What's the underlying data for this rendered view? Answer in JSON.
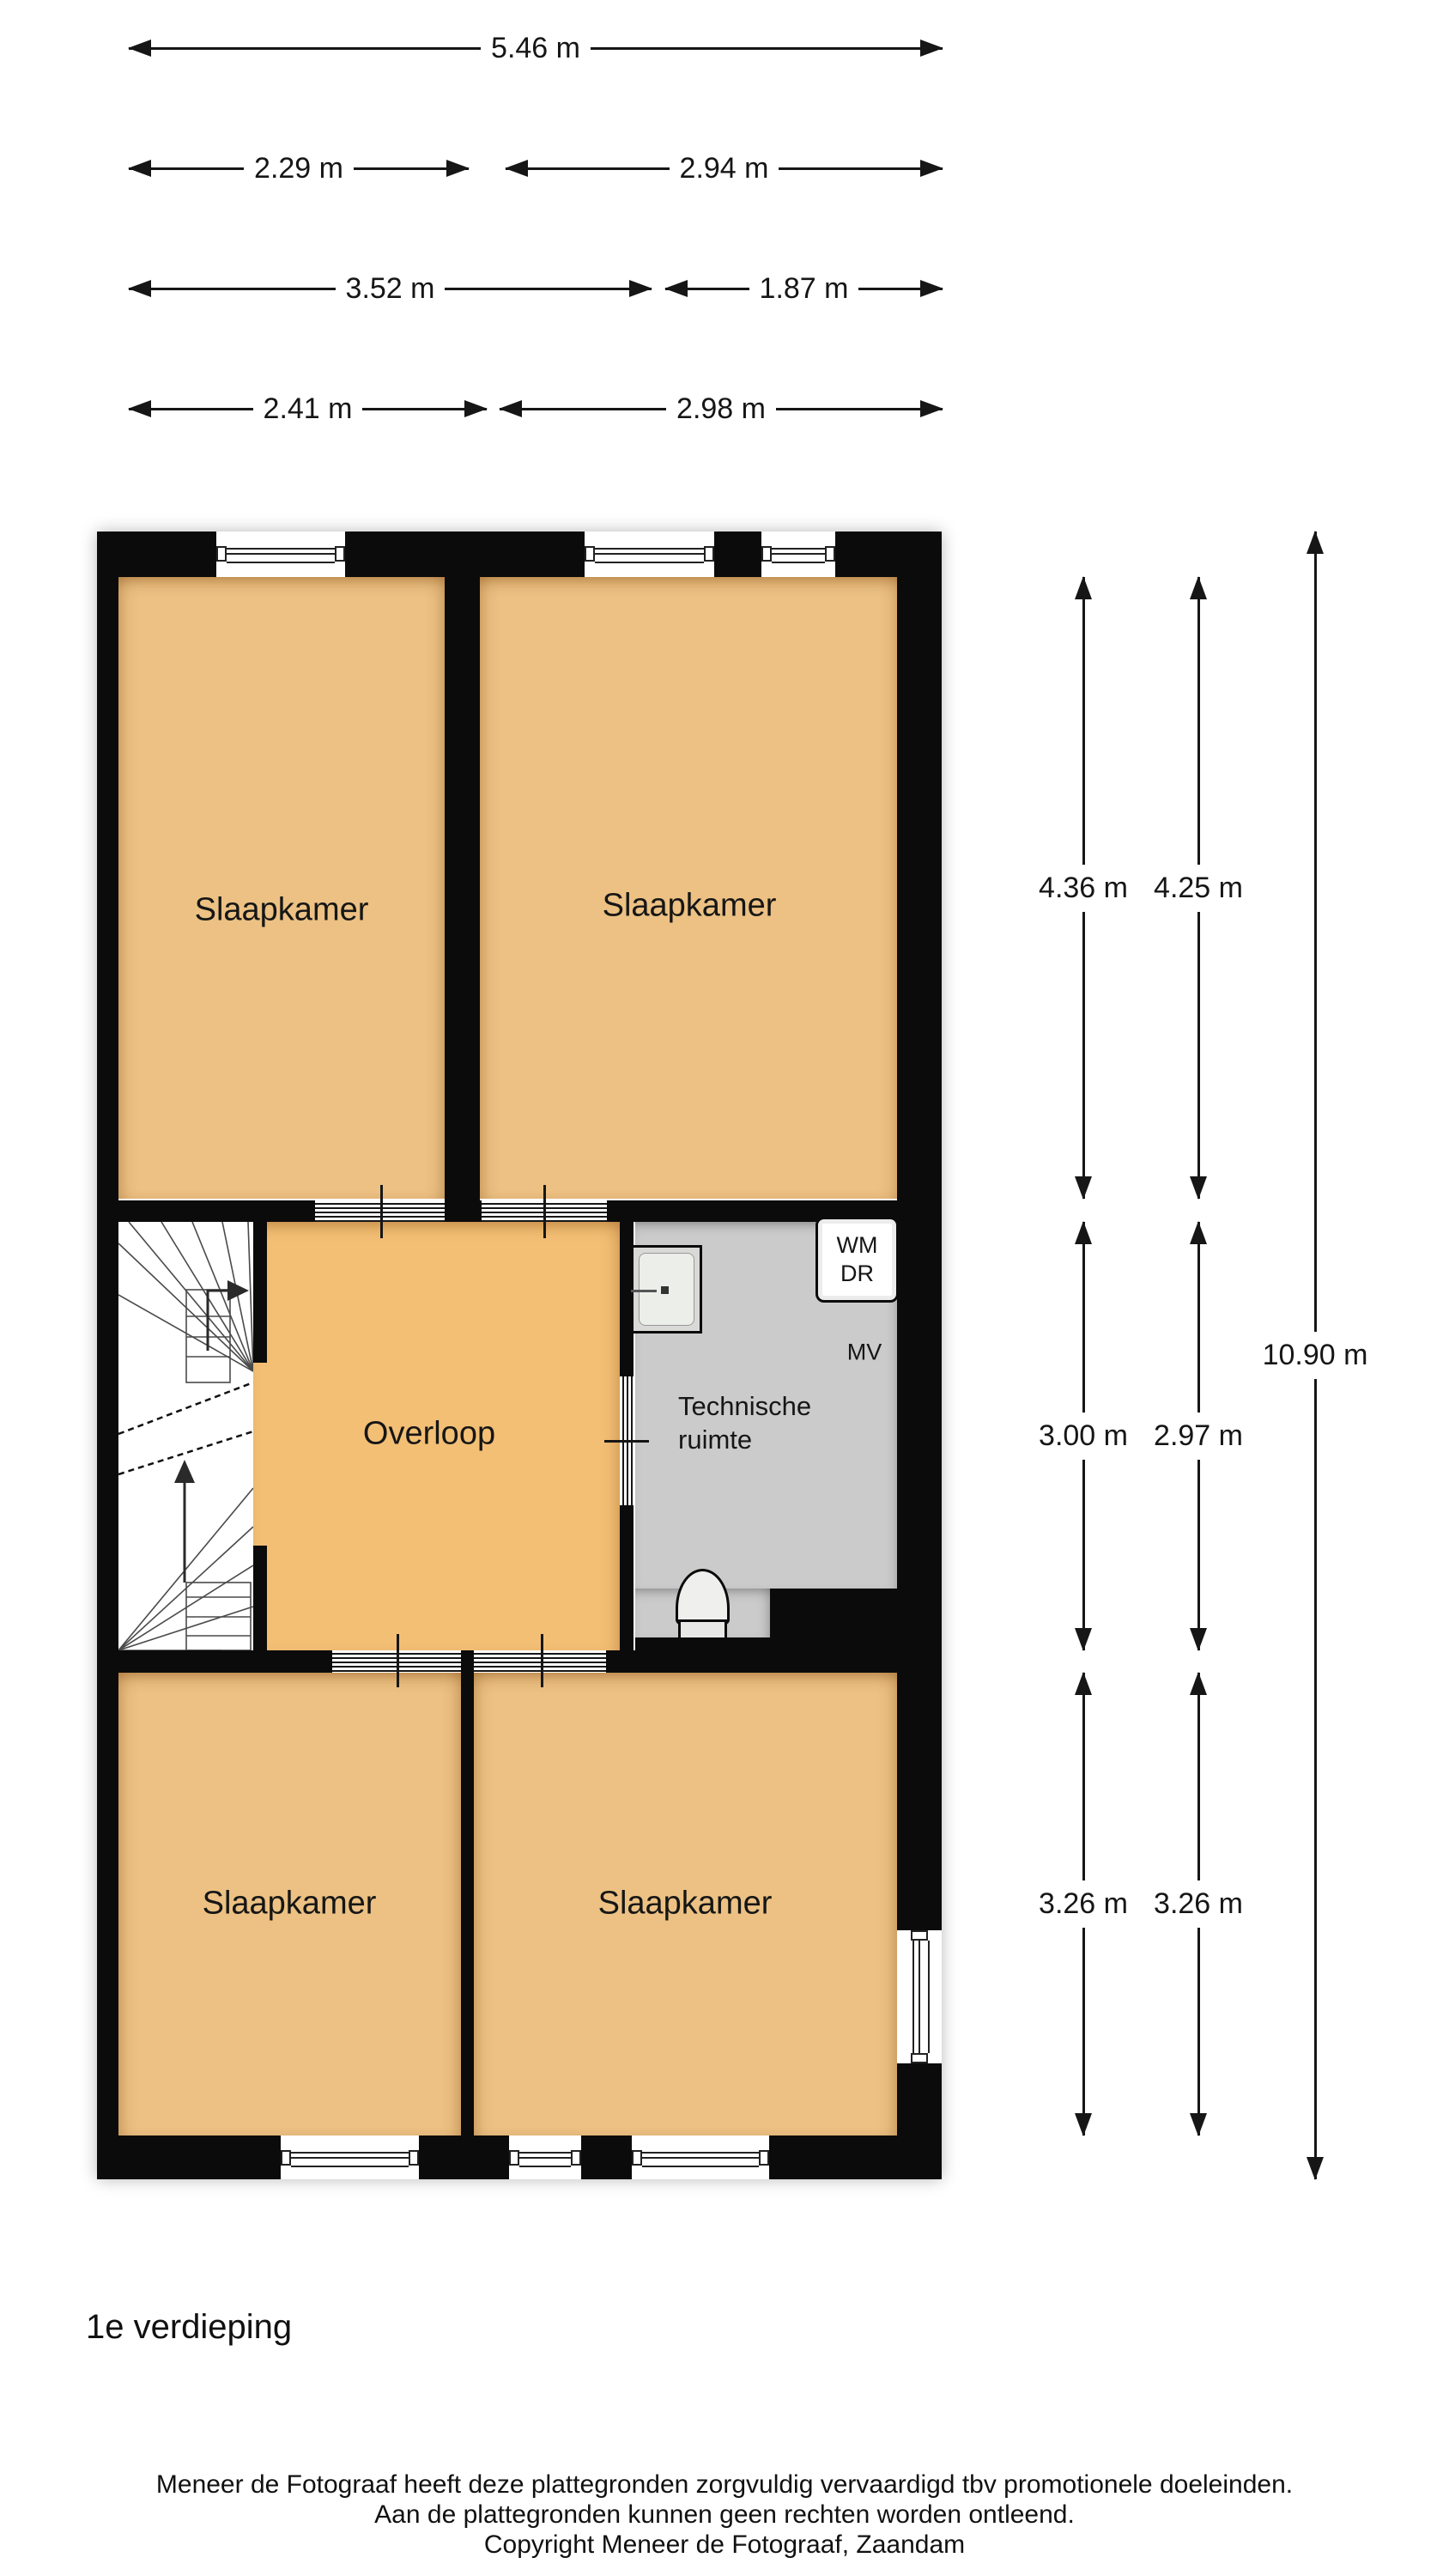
{
  "colors": {
    "wall": "#0b0b0b",
    "tan": "#ecc183",
    "tan2": "#f3bf75",
    "gray": "#cbcbcb",
    "paper": "#ffffff",
    "ink": "#161616"
  },
  "header_dimensions": {
    "rows": [
      {
        "segments": [
          {
            "label": "5.46 m"
          }
        ]
      },
      {
        "segments": [
          {
            "label": "2.29 m"
          },
          {
            "label": "2.94 m"
          }
        ]
      },
      {
        "segments": [
          {
            "label": "3.52 m"
          },
          {
            "label": "1.87 m"
          }
        ]
      },
      {
        "segments": [
          {
            "label": "2.41 m"
          },
          {
            "label": "2.98 m"
          }
        ]
      }
    ]
  },
  "side_dimensions": {
    "columns": [
      {
        "segments": [
          {
            "label": "4.36 m"
          },
          {
            "label": "3.00 m"
          },
          {
            "label": "3.26 m"
          }
        ]
      },
      {
        "segments": [
          {
            "label": "4.25 m"
          },
          {
            "label": "2.97 m"
          },
          {
            "label": "3.26 m"
          }
        ]
      },
      {
        "segments": [
          {
            "label": "10.90 m"
          }
        ]
      }
    ]
  },
  "rooms": {
    "bedroom_top_left": "Slaapkamer",
    "bedroom_top_right": "Slaapkamer",
    "landing": "Overloop",
    "technical_line1": "Technische",
    "technical_line2": "ruimte",
    "bedroom_bottom_left": "Slaapkamer",
    "bedroom_bottom_right": "Slaapkamer"
  },
  "fixtures": {
    "washing_machine": "WM",
    "dryer": "DR",
    "mechanical_ventilation": "MV"
  },
  "floor_label": "1e verdieping",
  "footer": {
    "line1": "Meneer de Fotograaf heeft deze plattegronden zorgvuldig vervaardigd tbv promotionele doeleinden.",
    "line2": "Aan de plattegronden kunnen geen rechten worden ontleend.",
    "line3": "Copyright Meneer de Fotograaf, Zaandam"
  }
}
